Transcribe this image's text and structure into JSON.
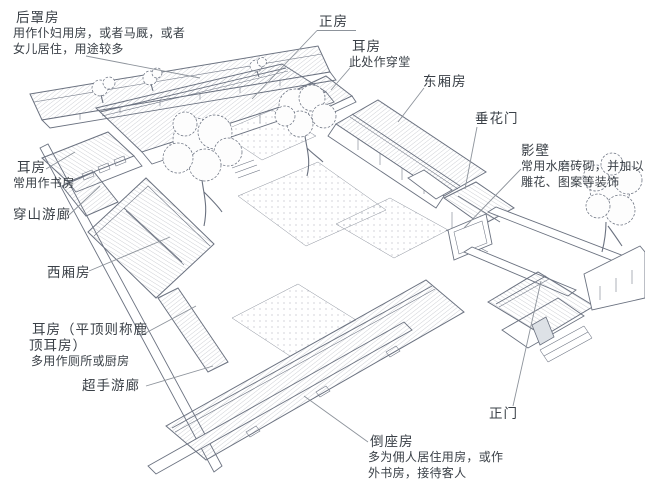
{
  "colors": {
    "ink": "#6b7280",
    "text": "#3a4047",
    "leader": "#8d939b",
    "paper": "#ffffff"
  },
  "labels": {
    "rear_building": {
      "title": "后罩房",
      "lines": [
        "用作仆妇用房，或者马厩，或者",
        "女儿居住，用途较多"
      ]
    },
    "main_hall": {
      "title": "正房"
    },
    "ear_room_passage": {
      "title": "耳房",
      "lines": [
        "此处作穿堂"
      ]
    },
    "east_wing": {
      "title": "东厢房"
    },
    "festoon_gate": {
      "title": "垂花门"
    },
    "screen_wall": {
      "title": "影壁",
      "lines": [
        "常用水磨砖砌，并加以",
        "雕花、图案等装饰"
      ]
    },
    "ear_room_study": {
      "title": "耳房",
      "lines": [
        "常用作书房"
      ]
    },
    "through_hill_corridor": {
      "title": "穿山游廊"
    },
    "west_wing": {
      "title": "西厢房"
    },
    "ear_room_flat": {
      "title": "耳房（平顶则称鹿",
      "title_line2": "顶耳房）",
      "lines": [
        "多用作厕所或厨房"
      ]
    },
    "folded_corridor": {
      "title": "超手游廊"
    },
    "front_building": {
      "title": "倒座房",
      "lines": [
        "多为佣人居住用房，或作",
        "外书房，接待客人"
      ]
    },
    "main_gate": {
      "title": "正门"
    }
  }
}
